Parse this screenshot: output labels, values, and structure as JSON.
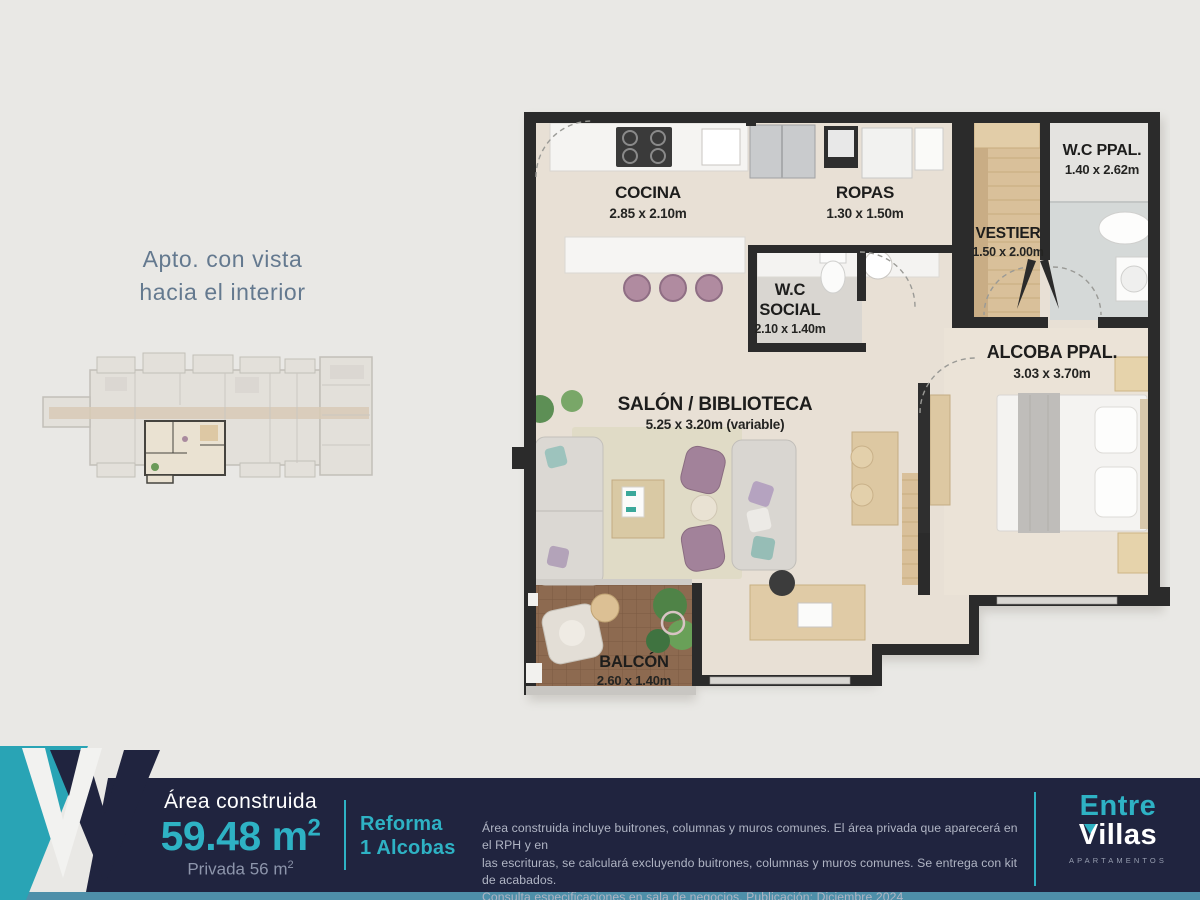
{
  "header": {
    "line1": "Apto. con vista",
    "line2": "hacia el interior"
  },
  "plan": {
    "rooms": {
      "cocina": {
        "name": "COCINA",
        "dims": "2.85 x 2.10m"
      },
      "ropas": {
        "name": "ROPAS",
        "dims": "1.30 x 1.50m"
      },
      "wc_social": {
        "name1": "W.C",
        "name2": "SOCIAL",
        "dims": "2.10 x 1.40m"
      },
      "wc_ppal": {
        "name": "W.C PPAL.",
        "dims": "1.40 x 2.62m"
      },
      "vestier": {
        "name": "VESTIER",
        "dims": "1.50 x 2.00m"
      },
      "alcoba": {
        "name": "ALCOBA PPAL.",
        "dims": "3.03 x 3.70m"
      },
      "salon": {
        "name": "SALÓN / BIBLIOTECA",
        "dims": "5.25 x 3.20m (variable)"
      },
      "balcon": {
        "name": "BALCÓN",
        "dims": "2.60 x 1.40m"
      }
    }
  },
  "footer": {
    "area_label": "Área construida",
    "area_value": "59.48 m",
    "area_sup": "2",
    "privada_label": "Privada 56 m",
    "privada_sup": "2",
    "reforma_line1": "Reforma",
    "reforma_line2": "1 Alcobas",
    "disclaimer_line1": "Área construida incluye buitrones, columnas y muros comunes. El área privada que aparecerá en el RPH y en",
    "disclaimer_line2": "las escrituras, se calculará excluyendo buitrones, columnas y muros comunes. Se entrega con kit de acabados.",
    "disclaimer_line3": "Consulta especificaciones en sala de negocios. Publicación: Diciembre 2024",
    "brand_line1": "Entre",
    "brand_line2": "Villas",
    "brand_line3": "APARTAMENTOS"
  },
  "colors": {
    "accent_teal": "#2eb2c4",
    "bar_navy": "#20243f",
    "logo_teal_wing": "#29a4b5",
    "bottom_strip": "#4e8fa9",
    "wall_dark": "#2b2b2b",
    "floor_beige": "#e8e0d5",
    "balcony_brown": "#8d6a50",
    "headline_blue": "#64798f"
  }
}
